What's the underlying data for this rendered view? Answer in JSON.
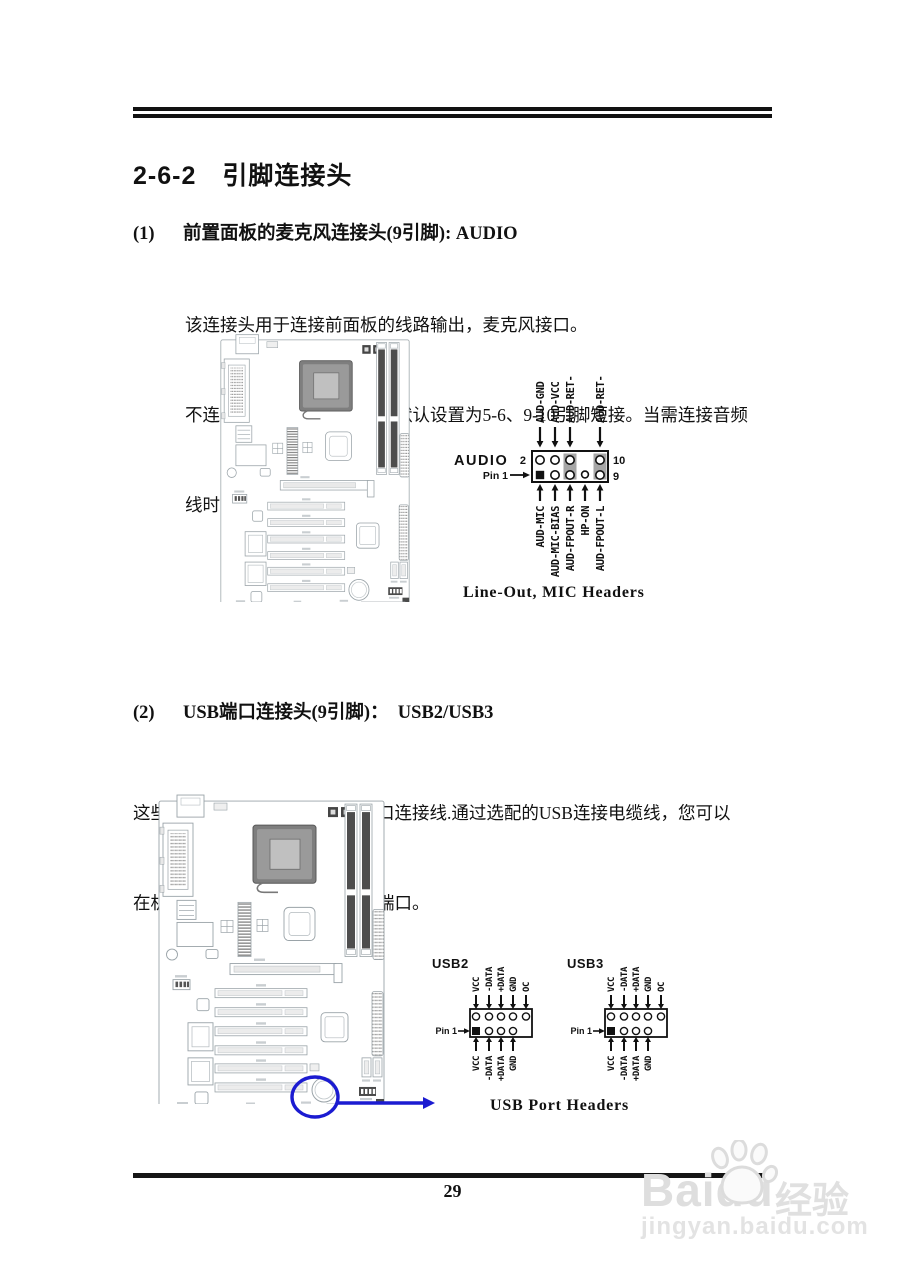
{
  "header": {
    "title": "2-6-2　引脚连接头"
  },
  "page": {
    "number": "29"
  },
  "section1": {
    "num": "(1)",
    "heading": "前置面板的麦克风连接头(9引脚): AUDIO",
    "lines": [
      "该连接头用于连接前面板的线路输出，麦克风接口。",
      "不连接音频线，该连接头的默认设置为5-6、9-10引脚短接。当需连接音频",
      "线时，必须取下该跳线帽。"
    ],
    "audio_header": {
      "name": "AUDIO",
      "pin1": "Pin 1",
      "pin_top_left": "2",
      "pin_top_right": "10",
      "pin_bottom_right": "9",
      "top_pins": [
        "AUD-GND",
        "AUD-VCC",
        "AUD-RET-R",
        "AUD-RET-L"
      ],
      "bottom_pins": [
        "AUD-MIC",
        "AUD-MIC-BIAS",
        "AUD-FPOUT-R",
        "HP-ON",
        "AUD-FPOUT-L"
      ],
      "caption": "Line-Out, MIC Headers"
    }
  },
  "section2": {
    "num": "(2)",
    "heading": "USB端口连接头(9引脚)：  USB2/USB3",
    "lines": [
      "这些连接头被用于附加的USB端口连接线.通过选配的USB连接电缆线，您可以",
      "在机箱背板增加两个附加的USB端口。"
    ],
    "usb2": {
      "name": "USB2",
      "pin1": "Pin 1",
      "top_pins": [
        "VCC",
        "-DATA",
        "+DATA",
        "GND",
        "OC"
      ],
      "bottom_pins": [
        "VCC",
        "-DATA",
        "+DATA",
        "GND"
      ]
    },
    "usb3": {
      "name": "USB3",
      "pin1": "Pin 1",
      "top_pins": [
        "VCC",
        "-DATA",
        "+DATA",
        "GND",
        "OC"
      ],
      "bottom_pins": [
        "VCC",
        "-DATA",
        "+DATA",
        "GND"
      ]
    },
    "caption": "USB Port Headers"
  },
  "watermark": {
    "brand": "Baidu",
    "brand_suffix": "经验",
    "url": "jingyan.baidu.com"
  },
  "colors": {
    "highlight_blue": "#1b1bd1",
    "dimm_dark": "#4d4d4d",
    "line_gray": "#9aa3a8"
  }
}
